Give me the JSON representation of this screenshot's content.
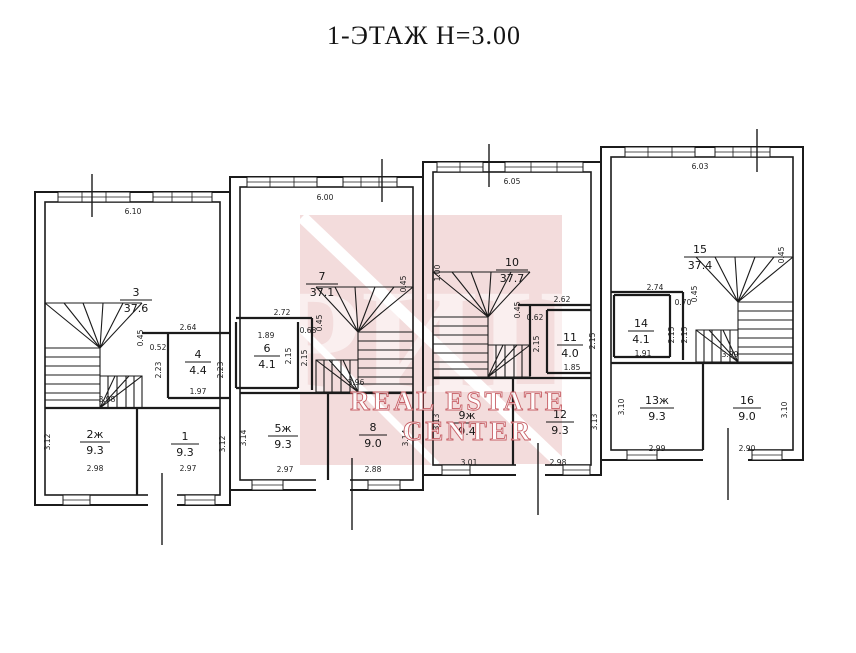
{
  "title": "1-ЭТАЖ Н=3.00",
  "watermark": {
    "brand": "РИЦ",
    "line1": "REAL ESTATE",
    "line2": "CENTER",
    "color": "#f3dcdc",
    "accent": "#c4555c"
  },
  "units": {
    "u1": {
      "rooms": {
        "r3": {
          "num": "3",
          "area": "37.6"
        },
        "r4": {
          "num": "4",
          "area": "4.4"
        },
        "r2": {
          "num": "2ж",
          "area": "9.3"
        },
        "r1": {
          "num": "1",
          "area": "9.3"
        }
      },
      "dims": {
        "width": "6.10",
        "d264": "2.64",
        "d045": "0.45",
        "d052": "0.52",
        "d223a": "2.23",
        "d223b": "2.23",
        "d197": "1.97",
        "d398": "3.98",
        "d312a": "3.12",
        "d298": "2.98",
        "d297": "2.97",
        "d312b": "3.12"
      }
    },
    "u2": {
      "rooms": {
        "r7": {
          "num": "7",
          "area": "37.1"
        },
        "r6": {
          "num": "6",
          "area": "4.1"
        },
        "r5": {
          "num": "5ж",
          "area": "9.3"
        },
        "r8": {
          "num": "8",
          "area": "9.0"
        }
      },
      "dims": {
        "width": "6.00",
        "d272": "2.72",
        "d189": "1.89",
        "d068": "0.68",
        "d045": "0.45",
        "d215a": "2.15",
        "d215b": "2.15",
        "d396": "3.96",
        "d045b": "0.45",
        "d314a": "3.14",
        "d297": "2.97",
        "d288": "2.88",
        "d314b": "3.14"
      }
    },
    "u3": {
      "rooms": {
        "r10": {
          "num": "10",
          "area": "37.7"
        },
        "r11": {
          "num": "11",
          "area": "4.0"
        },
        "r9": {
          "num": "9ж",
          "area": "9.4"
        },
        "r12": {
          "num": "12",
          "area": "9.3"
        }
      },
      "dims": {
        "width": "6.05",
        "d100": "1.00",
        "d262": "2.62",
        "d045": "0.45",
        "d062": "0.62",
        "d215a": "2.15",
        "d215b": "2.15",
        "d185": "1.85",
        "d301": "3.01",
        "d313a": "3.13",
        "d298": "2.98",
        "d313b": "3.13"
      }
    },
    "u4": {
      "rooms": {
        "r15": {
          "num": "15",
          "area": "37.4"
        },
        "r14": {
          "num": "14",
          "area": "4.1"
        },
        "r13": {
          "num": "13ж",
          "area": "9.3"
        },
        "r16": {
          "num": "16",
          "area": "9.0"
        }
      },
      "dims": {
        "width": "6.03",
        "d274": "2.74",
        "d045": "0.45",
        "d070": "0.70",
        "d215a": "2.15",
        "d215b": "2.15",
        "d191": "1.91",
        "d399": "3.99",
        "d045b": "0.45",
        "d310a": "3.10",
        "d299": "2.99",
        "d290": "2.90",
        "d310b": "3.10"
      }
    }
  }
}
